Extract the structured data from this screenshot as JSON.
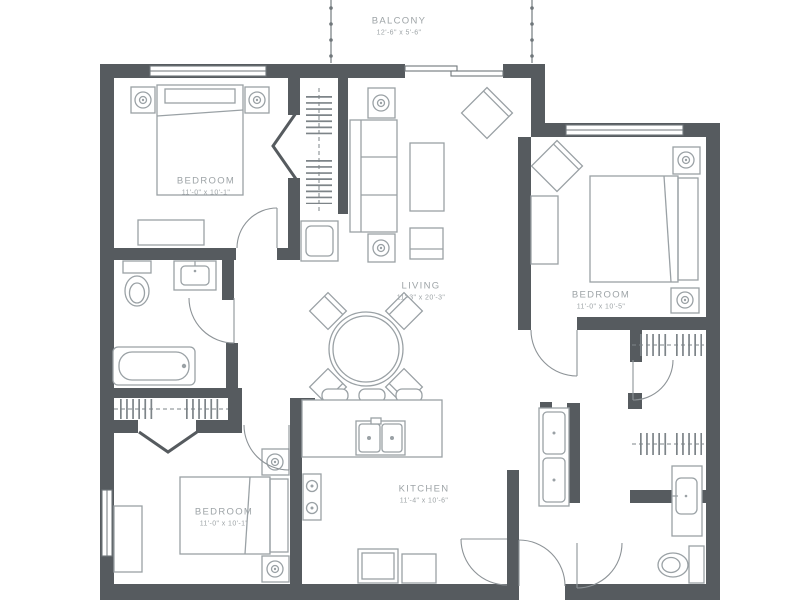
{
  "colors": {
    "wall": "#565b5f",
    "furniture_line": "#9aa1a5",
    "door_arc": "#8d9397",
    "hanger": "#7d8488",
    "text": "#9ea4a7",
    "background": "#ffffff"
  },
  "rooms": {
    "balcony": {
      "label": "BALCONY",
      "dimensions": "12'-6\" x 5'-6\""
    },
    "bedroom_top_left": {
      "label": "BEDROOM",
      "dimensions": "11'-0\" x 10'-1\""
    },
    "living": {
      "label": "LIVING",
      "dimensions": "11'-3\" x 20'-3\""
    },
    "bedroom_right": {
      "label": "BEDROOM",
      "dimensions": "11'-0\" x 10'-5\""
    },
    "kitchen": {
      "label": "KITCHEN",
      "dimensions": "11'-4\" x 10'-6\""
    },
    "bedroom_bottom_left": {
      "label": "BEDROOM",
      "dimensions": "11'-0\" x 10'-1\""
    }
  }
}
